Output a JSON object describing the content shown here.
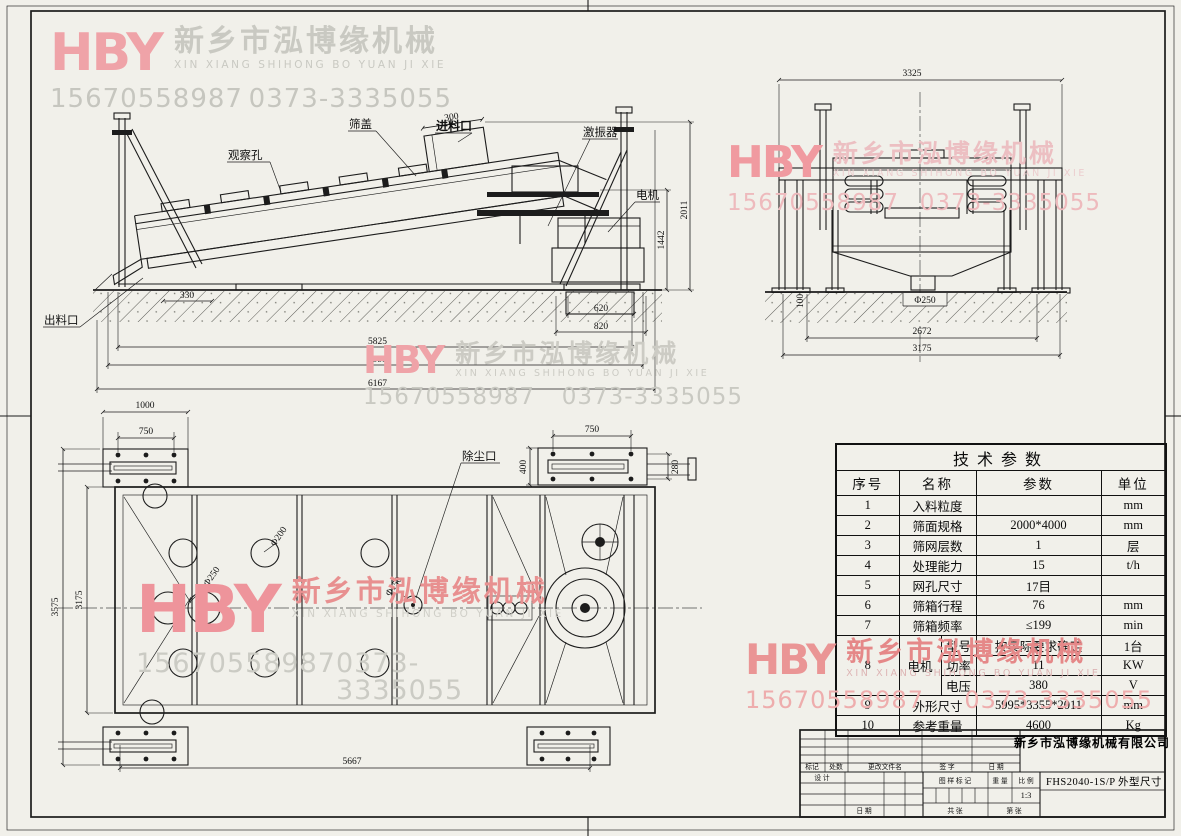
{
  "watermark": {
    "logo": "HBY",
    "company_cn": "新乡市泓博缘机械",
    "company_en": "XIN XIANG SHIHONG BO YUAN JI XIE",
    "phone_mobile": "15670558987",
    "phone_tel": "0373-3335055",
    "colors": {
      "pink": "#f09aa0",
      "red": "#e58888",
      "gray": "#c9c9c2"
    }
  },
  "side_view": {
    "labels": {
      "observation_hole": "观察孔",
      "screen_cover": "筛盖",
      "feed_inlet": "进料口",
      "exciter": "激振器",
      "motor": "电机",
      "discharge_outlet": "出料口"
    },
    "dims": {
      "feed_300": "300",
      "height_2011": "2011",
      "height_1442": "1442",
      "foot_330": "330",
      "found_620": "620",
      "found_820": "820",
      "len_5825": "5825",
      "len_5995": "5995",
      "len_6167": "6167"
    }
  },
  "end_view": {
    "dims": {
      "w_3325": "3325",
      "outlet_dia": "Φ250",
      "pit_100": "100",
      "w_2672": "2672",
      "w_3175": "3175"
    }
  },
  "top_view": {
    "labels": {
      "dust_port": "除尘口"
    },
    "dims": {
      "plate_1000": "1000",
      "plate_750_left": "750",
      "plate_750_right": "750",
      "plate_400": "400",
      "plate_280": "280",
      "w_3575": "3575",
      "w_3175": "3175",
      "len_5667": "5667",
      "dia_250": "Φ250",
      "dia_200": "Φ200",
      "dia_150": "Φ150"
    }
  },
  "spec_table": {
    "title": "技术参数",
    "headers": [
      "序号",
      "名称",
      "参数",
      "单位"
    ],
    "rows": [
      {
        "no": "1",
        "name": "入料粒度",
        "value": "",
        "unit": "mm"
      },
      {
        "no": "2",
        "name": "筛面规格",
        "value": "2000*4000",
        "unit": "mm"
      },
      {
        "no": "3",
        "name": "筛网层数",
        "value": "1",
        "unit": "层"
      },
      {
        "no": "4",
        "name": "处理能力",
        "value": "15",
        "unit": "t/h"
      },
      {
        "no": "5",
        "name": "网孔尺寸",
        "value": "17目",
        "unit": ""
      },
      {
        "no": "6",
        "name": "筛箱行程",
        "value": "76",
        "unit": "mm"
      },
      {
        "no": "7",
        "name": "筛箱频率",
        "value": "≤199",
        "unit": "min"
      }
    ],
    "motor_row": {
      "no": "8",
      "name": "电机",
      "subrows": [
        {
          "label": "型号",
          "value": "按实际要求确定",
          "unit": "1台"
        },
        {
          "label": "功率",
          "value": "11",
          "unit": "KW"
        },
        {
          "label": "电压",
          "value": "380",
          "unit": "V"
        }
      ]
    },
    "tail_rows": [
      {
        "no": "9",
        "name": "外形尺寸",
        "value": "5995*3355*2011",
        "unit": "mm"
      },
      {
        "no": "10",
        "name": "参考重量",
        "value": "4600",
        "unit": "Kg"
      }
    ]
  },
  "title_block": {
    "company": "新乡市泓博缘机械有限公司",
    "drawing_no": "FHS2040-1S/P",
    "drawing_title": "外型尺寸",
    "rev_headers": [
      "标记",
      "处数",
      "更改文件名",
      "签 字",
      "日 期"
    ],
    "design_label": "设 计",
    "date_label": "日 期",
    "mark_label": "图 样 标 记",
    "weight_label": "重 量",
    "scale_label": "比 例",
    "scale_value": "1:3",
    "sheet_total": "共  张",
    "sheet_no": "第  张"
  }
}
